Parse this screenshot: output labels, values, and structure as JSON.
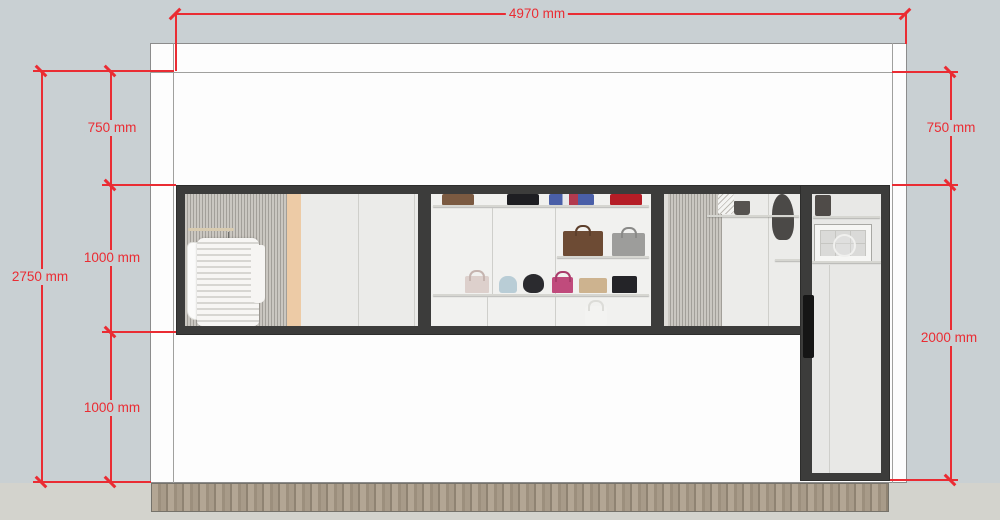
{
  "drawing": {
    "type": "storefront-elevation",
    "dimensions": {
      "top_width": "4970 mm",
      "left_total_height": "2750 mm",
      "left_top_offset": "750 mm",
      "window_height": "1000 mm",
      "bottom_wall_height": "1000 mm",
      "right_top_offset": "750 mm",
      "door_height": "2000 mm"
    },
    "colors": {
      "dimension_red": "#ea2c33",
      "background_sky": "#c9d0d3",
      "ground": "#d3d3cd",
      "wall_white": "#fdfdfd",
      "frame_dark": "#3c3c3b",
      "baseboard_wood": "#a89b89",
      "slat_panel": "#b8b5af",
      "accent_wood_strip": "#edcba6"
    }
  }
}
